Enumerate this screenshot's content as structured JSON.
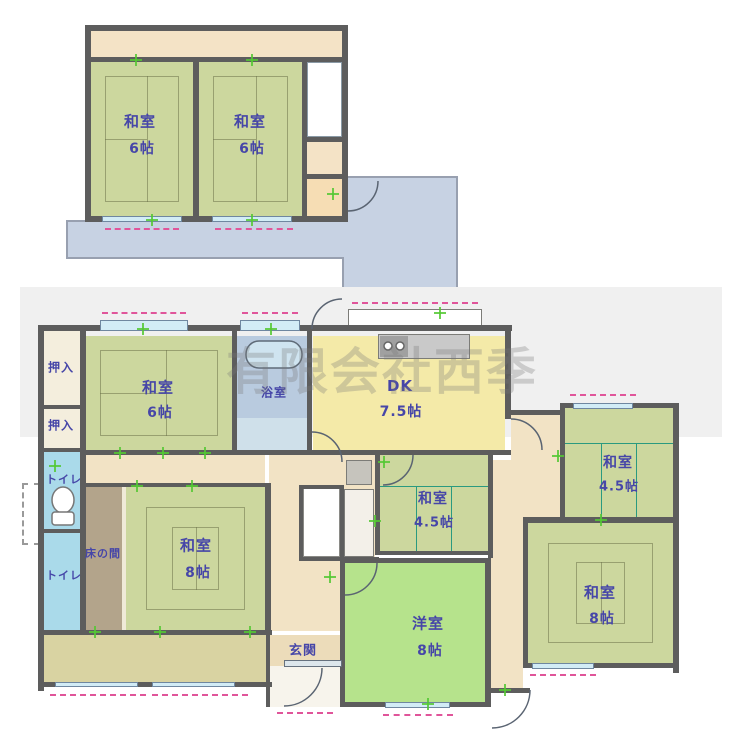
{
  "watermark": "有限会社西季",
  "colors": {
    "wall": "#5d5d5d",
    "tatami": "#ccd79e",
    "tatami_line": "#7e8663",
    "teal_line": "#2a9a80",
    "bright_green": "#b6e38c",
    "dk_yellow": "#f4eaa8",
    "hall_cream": "#f2e3c5",
    "strip_cream": "#f4e3c6",
    "peach": "#f6ddb4",
    "bath_blue": "#b9cbdf",
    "bath_light": "#cfe0ea",
    "toilet_blue": "#aadaea",
    "veranda_khaki": "#d9d3a2",
    "genkan_tile": "#ecdcba",
    "tokonoma_brown": "#b3a48b",
    "roof_blue": "#c7d2e3",
    "window_blue": "#d2ecf6",
    "pink": "#e0559a",
    "tick_green": "#54c832",
    "label_blue": "#4646a8",
    "closet_cream": "#f4eedd",
    "gray_band": "#f0f0f0",
    "white": "#ffffff",
    "stair_stripe": "#a9cede"
  },
  "floor2": {
    "rooms": [
      {
        "label": "和室",
        "size": "6帖"
      },
      {
        "label": "和室",
        "size": "6帖"
      }
    ],
    "features": [
      "階段",
      "バルコニー/下屋"
    ]
  },
  "floor1": {
    "rooms": [
      {
        "label": "和室",
        "size": "6帖"
      },
      {
        "label": "浴室",
        "size": ""
      },
      {
        "label": "DK",
        "size": "7.5帖"
      },
      {
        "label": "和室",
        "size": "4.5帖"
      },
      {
        "label": "和室",
        "size": "4.5帖"
      },
      {
        "label": "和室",
        "size": "8帖"
      },
      {
        "label": "和室",
        "size": "8帖"
      },
      {
        "label": "洋室",
        "size": "8帖"
      },
      {
        "label": "押入",
        "size": ""
      },
      {
        "label": "押入",
        "size": ""
      },
      {
        "label": "トイレ",
        "size": ""
      },
      {
        "label": "トイレ",
        "size": ""
      },
      {
        "label": "床の間",
        "size": ""
      },
      {
        "label": "玄関",
        "size": ""
      }
    ]
  },
  "geometry": {
    "roof_points": "67,221 347,221 347,177 457,177 457,288 343,288 343,258 67,258",
    "fills": [
      {
        "n": "background-band",
        "x": 20,
        "y": 287,
        "w": 702,
        "h": 150,
        "c": "gray_band",
        "cls": "band"
      },
      {
        "n": "balcony-strip-2f",
        "x": 91,
        "y": 31,
        "w": 251,
        "h": 26,
        "c": "strip_cream"
      },
      {
        "n": "room-washitsu-6-2f-left",
        "x": 91,
        "y": 62,
        "w": 102,
        "h": 154,
        "c": "tatami",
        "pat": "six"
      },
      {
        "n": "room-washitsu-6-2f-right",
        "x": 199,
        "y": 62,
        "w": 103,
        "h": 154,
        "c": "tatami",
        "pat": "six"
      },
      {
        "n": "stairs-2f",
        "x": 307,
        "y": 62,
        "w": 35,
        "h": 75,
        "c": "white",
        "cls": "stairs2f"
      },
      {
        "n": "landing-2f",
        "x": 307,
        "y": 142,
        "w": 35,
        "h": 32,
        "c": "strip_cream"
      },
      {
        "n": "storage-2f",
        "x": 307,
        "y": 179,
        "w": 35,
        "h": 37,
        "c": "peach"
      },
      {
        "n": "hall-upper",
        "x": 86,
        "y": 455,
        "w": 179,
        "h": 30,
        "c": "hall_cream"
      },
      {
        "n": "hall-center",
        "x": 269,
        "y": 455,
        "w": 106,
        "h": 176,
        "c": "hall_cream"
      },
      {
        "n": "hall-center-east",
        "x": 342,
        "y": 455,
        "w": 33,
        "h": 176,
        "c": "hall_cream"
      },
      {
        "n": "hall-east",
        "x": 488,
        "y": 460,
        "w": 35,
        "h": 228,
        "c": "hall_cream"
      },
      {
        "n": "hall-east-upper",
        "x": 511,
        "y": 415,
        "w": 49,
        "h": 102,
        "c": "hall_cream"
      },
      {
        "n": "hall-east-mid",
        "x": 523,
        "y": 455,
        "w": 37,
        "h": 62,
        "c": "hall_cream"
      },
      {
        "n": "room-washitsu-6-1f",
        "x": 86,
        "y": 336,
        "w": 146,
        "h": 114,
        "c": "tatami",
        "pat": "six"
      },
      {
        "n": "room-bathroom",
        "x": 237,
        "y": 336,
        "w": 70,
        "h": 114,
        "c": "bath_blue"
      },
      {
        "n": "bathroom-lower",
        "x": 237,
        "y": 418,
        "w": 70,
        "h": 32,
        "c": "bath_light"
      },
      {
        "n": "room-dk",
        "x": 313,
        "y": 336,
        "w": 192,
        "h": 114,
        "c": "dk_yellow"
      },
      {
        "n": "kitchen-counter",
        "x": 378,
        "y": 334,
        "w": 92,
        "h": 25,
        "c": "#c9c9c9",
        "cls": "boxed"
      },
      {
        "n": "kitchen-burner",
        "x": 380,
        "y": 336,
        "w": 28,
        "h": 21,
        "c": "#a0a0a0"
      },
      {
        "n": "bay-window",
        "x": 348,
        "y": 309,
        "w": 134,
        "h": 22,
        "c": "white",
        "cls": "boxed"
      },
      {
        "n": "room-washitsu-45-mid",
        "x": 380,
        "y": 455,
        "w": 108,
        "h": 96,
        "c": "tatami",
        "pat": "four"
      },
      {
        "n": "room-washitsu-45-right",
        "x": 565,
        "y": 408,
        "w": 108,
        "h": 109,
        "c": "tatami",
        "pat": "four"
      },
      {
        "n": "room-washitsu-8-right",
        "x": 528,
        "y": 523,
        "w": 145,
        "h": 140,
        "c": "tatami",
        "pat": "eight"
      },
      {
        "n": "room-yoshitsu-8",
        "x": 345,
        "y": 563,
        "w": 140,
        "h": 139,
        "c": "bright_green"
      },
      {
        "n": "tokonoma",
        "x": 86,
        "y": 487,
        "w": 36,
        "h": 143,
        "c": "tokonoma_brown"
      },
      {
        "n": "tokonoma-shelf",
        "x": 122,
        "y": 487,
        "w": 4,
        "h": 143,
        "c": "#f0ead8"
      },
      {
        "n": "room-washitsu-8-left",
        "x": 126,
        "y": 487,
        "w": 139,
        "h": 143,
        "c": "tatami",
        "pat": "eight"
      },
      {
        "n": "closet-oshiire-1",
        "x": 42,
        "y": 331,
        "w": 38,
        "h": 74,
        "c": "closet_cream"
      },
      {
        "n": "closet-oshiire-2",
        "x": 42,
        "y": 409,
        "w": 38,
        "h": 39,
        "c": "closet_cream"
      },
      {
        "n": "room-toilet-1",
        "x": 42,
        "y": 452,
        "w": 38,
        "h": 77,
        "c": "toilet_blue"
      },
      {
        "n": "room-toilet-2",
        "x": 42,
        "y": 533,
        "w": 38,
        "h": 97,
        "c": "toilet_blue"
      },
      {
        "n": "water-heater-box",
        "x": 22,
        "y": 483,
        "w": 18,
        "h": 62,
        "c": "white",
        "cls": "dashedbox"
      },
      {
        "n": "veranda",
        "x": 42,
        "y": 635,
        "w": 224,
        "h": 47,
        "c": "veranda_khaki"
      },
      {
        "n": "genkan-tiles",
        "x": 269,
        "y": 635,
        "w": 73,
        "h": 31,
        "c": "genkan_tile",
        "cls": "genkan-grid"
      },
      {
        "n": "genkan-porch",
        "x": 269,
        "y": 666,
        "w": 73,
        "h": 41,
        "c": "#f7f4ec"
      },
      {
        "n": "stairs-1f",
        "x": 303,
        "y": 487,
        "w": 37,
        "h": 70,
        "c": "white",
        "cls": "stairs1f"
      },
      {
        "n": "washroom",
        "x": 344,
        "y": 489,
        "w": 30,
        "h": 68,
        "c": "#f3f0e9",
        "cls": "boxed"
      },
      {
        "n": "appliance",
        "x": 346,
        "y": 460,
        "w": 26,
        "h": 25,
        "c": "#c6c4bd",
        "cls": "boxed"
      }
    ],
    "walls": [
      [
        85,
        25,
        263,
        6
      ],
      [
        85,
        25,
        6,
        197
      ],
      [
        342,
        25,
        6,
        197
      ],
      [
        85,
        216,
        263,
        6
      ],
      [
        85,
        57,
        263,
        5
      ],
      [
        193,
        57,
        6,
        164
      ],
      [
        302,
        57,
        5,
        164
      ],
      [
        302,
        137,
        46,
        5
      ],
      [
        302,
        174,
        46,
        5
      ],
      [
        38,
        325,
        474,
        6
      ],
      [
        38,
        325,
        6,
        366
      ],
      [
        80,
        331,
        6,
        304
      ],
      [
        42,
        405,
        38,
        4
      ],
      [
        42,
        448,
        38,
        4
      ],
      [
        42,
        529,
        38,
        4
      ],
      [
        82,
        450,
        230,
        5
      ],
      [
        232,
        331,
        5,
        119
      ],
      [
        307,
        331,
        5,
        119
      ],
      [
        312,
        450,
        199,
        5
      ],
      [
        505,
        331,
        6,
        88
      ],
      [
        375,
        455,
        5,
        100
      ],
      [
        488,
        455,
        5,
        103
      ],
      [
        375,
        551,
        118,
        4
      ],
      [
        340,
        558,
        151,
        5
      ],
      [
        340,
        558,
        5,
        149
      ],
      [
        485,
        558,
        6,
        149
      ],
      [
        340,
        702,
        151,
        5
      ],
      [
        560,
        403,
        119,
        5
      ],
      [
        560,
        403,
        5,
        119
      ],
      [
        673,
        403,
        6,
        270
      ],
      [
        523,
        517,
        156,
        6
      ],
      [
        523,
        517,
        5,
        151
      ],
      [
        523,
        663,
        156,
        5
      ],
      [
        38,
        630,
        234,
        5
      ],
      [
        38,
        682,
        234,
        5
      ],
      [
        266,
        631,
        4,
        76
      ],
      [
        511,
        410,
        52,
        5
      ],
      [
        485,
        688,
        45,
        5
      ],
      [
        265,
        483,
        6,
        152
      ],
      [
        82,
        483,
        189,
        4
      ],
      [
        299,
        485,
        44,
        4
      ],
      [
        299,
        485,
        4,
        76
      ],
      [
        340,
        485,
        4,
        76
      ],
      [
        299,
        557,
        80,
        4
      ]
    ],
    "windows": [
      [
        102,
        216,
        80,
        6
      ],
      [
        212,
        216,
        80,
        6
      ],
      [
        100,
        320,
        88,
        11
      ],
      [
        240,
        320,
        60,
        11
      ],
      [
        573,
        403,
        60,
        6
      ],
      [
        532,
        663,
        62,
        6
      ],
      [
        385,
        702,
        65,
        6
      ],
      [
        55,
        682,
        83,
        5
      ],
      [
        152,
        682,
        83,
        5
      ]
    ],
    "entrance_door": [
      284,
      660,
      58,
      7
    ],
    "dashes": [
      [
        105,
        228,
        74
      ],
      [
        215,
        228,
        78
      ],
      [
        102,
        312,
        84
      ],
      [
        242,
        312,
        56
      ],
      [
        352,
        302,
        126
      ],
      [
        570,
        394,
        66
      ],
      [
        530,
        674,
        66
      ],
      [
        383,
        714,
        70
      ],
      [
        50,
        694,
        96
      ],
      [
        152,
        694,
        96
      ],
      [
        277,
        712,
        56
      ]
    ],
    "ticks": [
      [
        136,
        60
      ],
      [
        252,
        60
      ],
      [
        152,
        220
      ],
      [
        252,
        220
      ],
      [
        333,
        194
      ],
      [
        143,
        329
      ],
      [
        271,
        329
      ],
      [
        440,
        313
      ],
      [
        55,
        466
      ],
      [
        120,
        453
      ],
      [
        163,
        453
      ],
      [
        205,
        453
      ],
      [
        137,
        486
      ],
      [
        192,
        486
      ],
      [
        330,
        577
      ],
      [
        384,
        462
      ],
      [
        375,
        521
      ],
      [
        558,
        456
      ],
      [
        601,
        520
      ],
      [
        428,
        704
      ],
      [
        95,
        632
      ],
      [
        160,
        632
      ],
      [
        250,
        632
      ],
      [
        505,
        690
      ]
    ],
    "labels": [
      {
        "n": "label-washitsu6-2f-left",
        "t": "和室",
        "x": 140,
        "y": 121,
        "fs": 15
      },
      {
        "n": "label-washitsu6-2f-left-size",
        "t": "6帖",
        "x": 142,
        "y": 148,
        "fs": 14
      },
      {
        "n": "label-washitsu6-2f-right",
        "t": "和室",
        "x": 250,
        "y": 121,
        "fs": 15
      },
      {
        "n": "label-washitsu6-2f-right-size",
        "t": "6帖",
        "x": 252,
        "y": 148,
        "fs": 14
      },
      {
        "n": "label-washitsu6-1f",
        "t": "和室",
        "x": 158,
        "y": 387,
        "fs": 15
      },
      {
        "n": "label-washitsu6-1f-size",
        "t": "6帖",
        "x": 160,
        "y": 412,
        "fs": 14
      },
      {
        "n": "label-bathroom",
        "t": "浴室",
        "x": 274,
        "y": 392,
        "fs": 12
      },
      {
        "n": "label-dk",
        "t": "DK",
        "x": 400,
        "y": 386,
        "fs": 15
      },
      {
        "n": "label-dk-size",
        "t": "7.5帖",
        "x": 401,
        "y": 411,
        "fs": 14
      },
      {
        "n": "label-washitsu45-mid",
        "t": "和室",
        "x": 433,
        "y": 498,
        "fs": 14
      },
      {
        "n": "label-washitsu45-mid-size",
        "t": "4.5帖",
        "x": 434,
        "y": 521,
        "fs": 13
      },
      {
        "n": "label-washitsu45-right",
        "t": "和室",
        "x": 618,
        "y": 462,
        "fs": 14
      },
      {
        "n": "label-washitsu45-right-size",
        "t": "4.5帖",
        "x": 619,
        "y": 485,
        "fs": 13
      },
      {
        "n": "label-washitsu8-left",
        "t": "和室",
        "x": 196,
        "y": 545,
        "fs": 15
      },
      {
        "n": "label-washitsu8-left-size",
        "t": "8帖",
        "x": 198,
        "y": 572,
        "fs": 14
      },
      {
        "n": "label-washitsu8-right",
        "t": "和室",
        "x": 600,
        "y": 592,
        "fs": 15
      },
      {
        "n": "label-washitsu8-right-size",
        "t": "8帖",
        "x": 602,
        "y": 618,
        "fs": 14
      },
      {
        "n": "label-yoshitsu8",
        "t": "洋室",
        "x": 428,
        "y": 623,
        "fs": 15
      },
      {
        "n": "label-yoshitsu8-size",
        "t": "8帖",
        "x": 430,
        "y": 650,
        "fs": 14
      },
      {
        "n": "label-oshiire-1",
        "t": "押入",
        "x": 61,
        "y": 367,
        "fs": 12
      },
      {
        "n": "label-oshiire-2",
        "t": "押入",
        "x": 61,
        "y": 425,
        "fs": 12
      },
      {
        "n": "label-toilet-1",
        "t": "トイレ",
        "x": 64,
        "y": 479,
        "fs": 11
      },
      {
        "n": "label-toilet-2",
        "t": "トイレ",
        "x": 64,
        "y": 575,
        "fs": 11
      },
      {
        "n": "label-tokonoma",
        "t": "床の間",
        "x": 103,
        "y": 553,
        "fs": 11
      },
      {
        "n": "label-genkan",
        "t": "玄関",
        "x": 303,
        "y": 649,
        "fs": 13
      }
    ],
    "door_arcs": [
      {
        "n": "door-arc-2f-storage",
        "d": "M378 181 A30 30 0 0 1 348 211"
      },
      {
        "n": "door-arc-back-door",
        "d": "M342 299 A30 30 0 0 0 312 329"
      },
      {
        "n": "door-arc-bathroom",
        "d": "M312 432 A30 30 0 0 1 342 462"
      },
      {
        "n": "door-arc-dk-east",
        "d": "M511 419 A31 31 0 0 1 542 450"
      },
      {
        "n": "door-arc-washitsu45-mid",
        "d": "M413 455 A30 30 0 0 1 383 485"
      },
      {
        "n": "door-arc-yoshitsu",
        "d": "M377 563 A32 32 0 0 1 345 595"
      },
      {
        "n": "door-arc-corridor-south",
        "d": "M530 690 A38 38 0 0 1 492 728"
      },
      {
        "n": "door-arc-genkan",
        "d": "M322 668 A38 38 0 0 1 284 706"
      }
    ],
    "fixtures": [
      {
        "n": "toilet-bowl",
        "type": "ellipse",
        "cx": 63,
        "cy": 500,
        "rx": 11,
        "ry": 13,
        "f": "#ffffff",
        "s": "#777777"
      },
      {
        "n": "toilet-tank",
        "type": "rect",
        "x": 52,
        "y": 512,
        "w": 22,
        "h": 13,
        "rx": 3,
        "f": "#ffffff",
        "s": "#777777"
      },
      {
        "n": "bathtub",
        "type": "rect",
        "x": 246,
        "y": 341,
        "w": 56,
        "h": 27,
        "rx": 13,
        "f": "#cfe4f0",
        "s": "#5f6b78"
      },
      {
        "n": "burner-1",
        "type": "circle",
        "cx": 388,
        "cy": 346,
        "r": 4,
        "f": "#ffffff",
        "s": "#666666"
      },
      {
        "n": "burner-2",
        "type": "circle",
        "cx": 400,
        "cy": 346,
        "r": 4,
        "f": "#ffffff",
        "s": "#666666"
      }
    ]
  }
}
